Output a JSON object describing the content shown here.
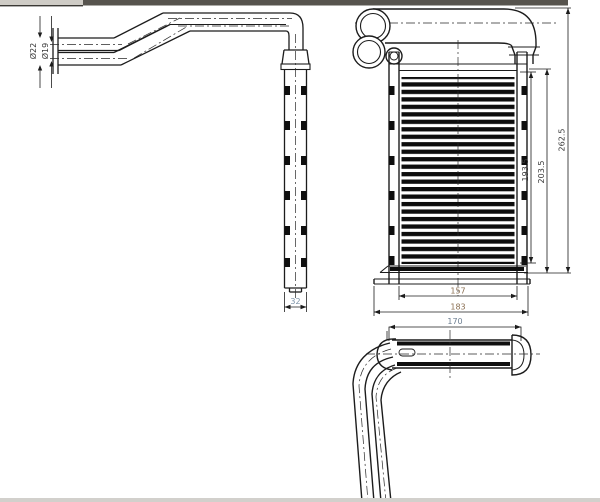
{
  "window": {
    "chrome_fragment": {
      "tab_color": "#cfccc6",
      "bar_color": "#57544e"
    }
  },
  "drawing": {
    "title": "heater-core-three-view-drawing",
    "line_color": "#1c1c1c",
    "background": "#ffffff",
    "views": {
      "side_view": "left side view with inlet/outlet pipes and tank",
      "front_view": "front view with finned core",
      "bottom_view": "bottom view with tank and down pipes"
    },
    "dimensions": {
      "pipe_dia_large": "Ø22",
      "pipe_dia_small": "Ø19",
      "tank_depth": "32",
      "core_fin_height": "193.5",
      "core_height": "203.5",
      "overall_height": "262.5",
      "core_fin_width": "157",
      "core_width": "183",
      "bottom_tank_length": "170"
    },
    "dim_colors": {
      "default": "#3a3a3a",
      "tank_depth": "#7d93a8",
      "core_fin_width": "#8a6f52",
      "core_width": "#8a6f52",
      "bottom_tank_length": "#6e7f92"
    }
  }
}
